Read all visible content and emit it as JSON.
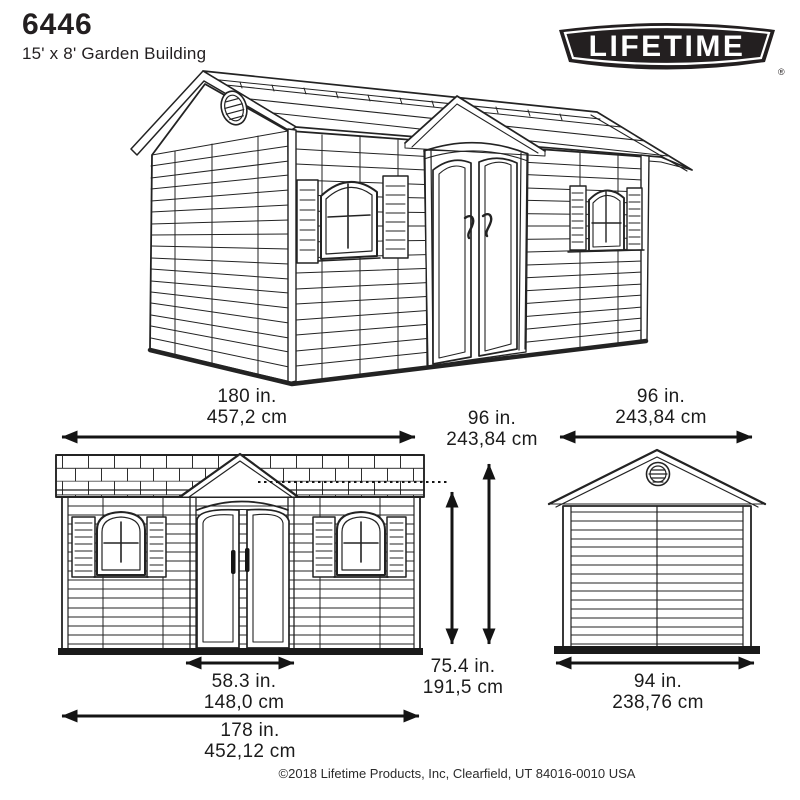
{
  "page": {
    "background": "#ffffff",
    "ink": "#231f20"
  },
  "header": {
    "model_number": "6446",
    "product_name": "15' x 8' Garden Building"
  },
  "logo": {
    "brand": "LIFETIME",
    "registered_mark": "®",
    "badge_color": "#231f20",
    "text_color": "#ffffff"
  },
  "dimensions": {
    "front_width": {
      "inches": "180 in.",
      "cm": "457,2 cm"
    },
    "total_height": {
      "inches": "96 in.",
      "cm": "243,84 cm"
    },
    "side_width": {
      "inches": "96 in.",
      "cm": "243,84 cm"
    },
    "eave_height": {
      "inches": "75.4 in.",
      "cm": "191,5 cm"
    },
    "door_width": {
      "inches": "58.3 in.",
      "cm": "148,0 cm"
    },
    "base_width": {
      "inches": "178 in.",
      "cm": "452,12 cm"
    },
    "side_base_width": {
      "inches": "94 in.",
      "cm": "238,76 cm"
    }
  },
  "footer": {
    "copyright": "©2018 Lifetime Products, Inc, Clearfield, UT 84016-0010 USA"
  }
}
